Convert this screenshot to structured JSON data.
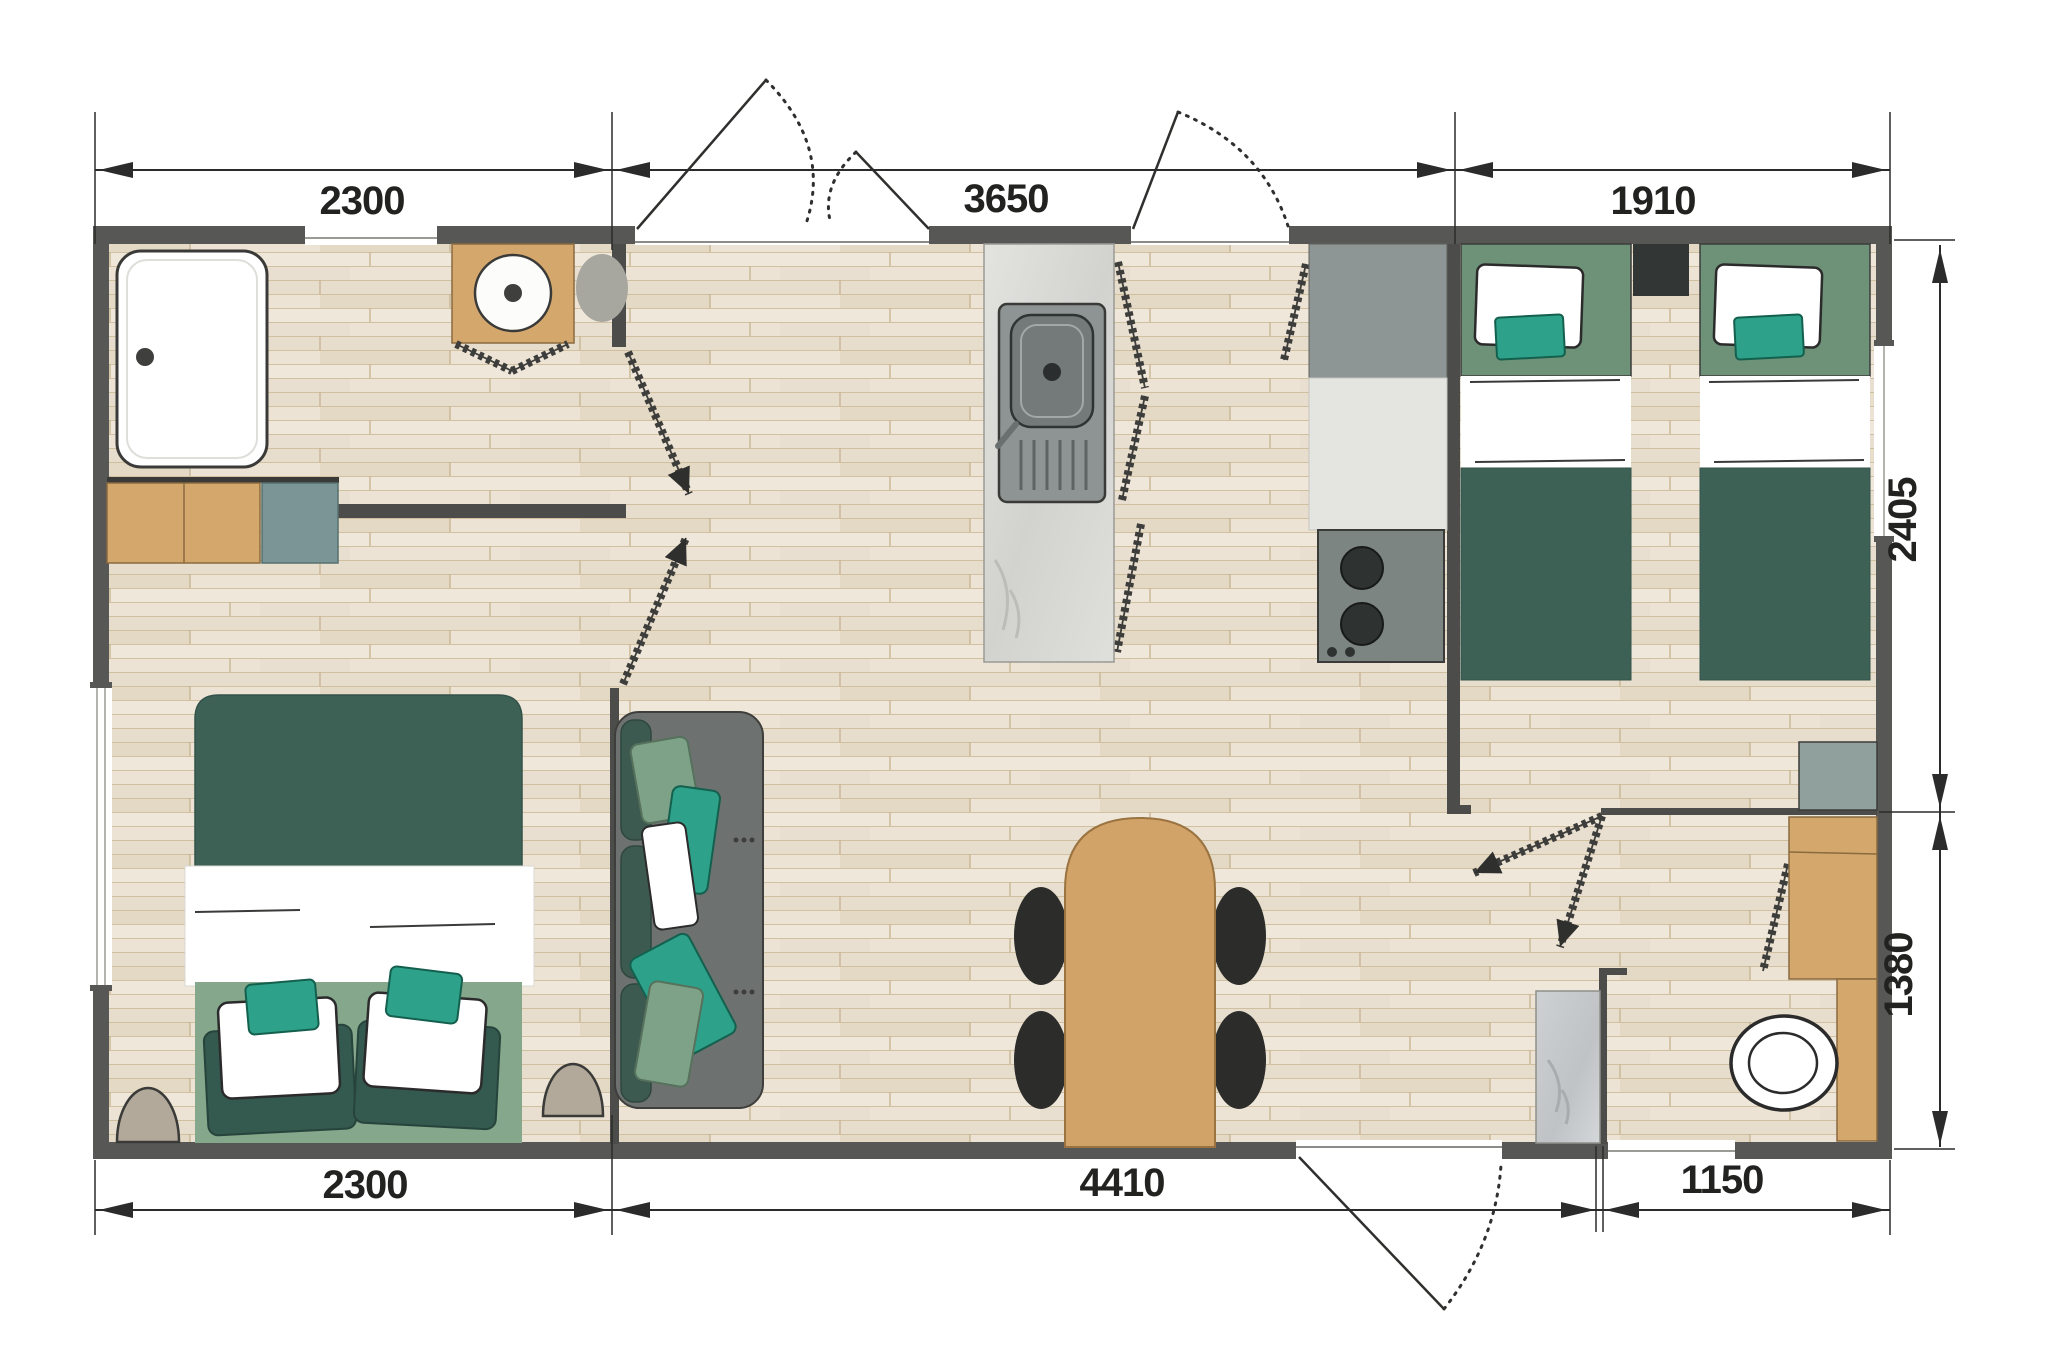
{
  "plan": {
    "type": "floor-plan",
    "units_shown": "millimetre-style numeric labels",
    "dims": {
      "top_left": "2300",
      "top_mid": "3650",
      "top_right": "1910",
      "bottom_left": "2300",
      "bottom_mid": "4410",
      "bottom_right": "1150",
      "right_upper": "2405",
      "right_lower": "1380"
    },
    "colors": {
      "wall": "#575755",
      "floor_wood": "#ece3d5",
      "furniture_tan": "#d4a76d",
      "green_dark": "#3e6156",
      "green_light": "#85a78b",
      "teal_accent": "#2da189",
      "gray_counter": "#8e9494",
      "dim_ink": "#222220"
    },
    "elements": [
      "shower-tray",
      "washbasin-unit",
      "bathroom-cabinets",
      "double-bed",
      "pouf",
      "window",
      "sofa",
      "dining-table",
      "dining-chair",
      "kitchen-island-sink",
      "hob-unit",
      "tall-kitchen-unit",
      "single-bed",
      "nightstand",
      "wardrobe",
      "wc-cabinet",
      "toilet",
      "vanity-slab",
      "door-leaf",
      "door-swing-arc"
    ]
  }
}
